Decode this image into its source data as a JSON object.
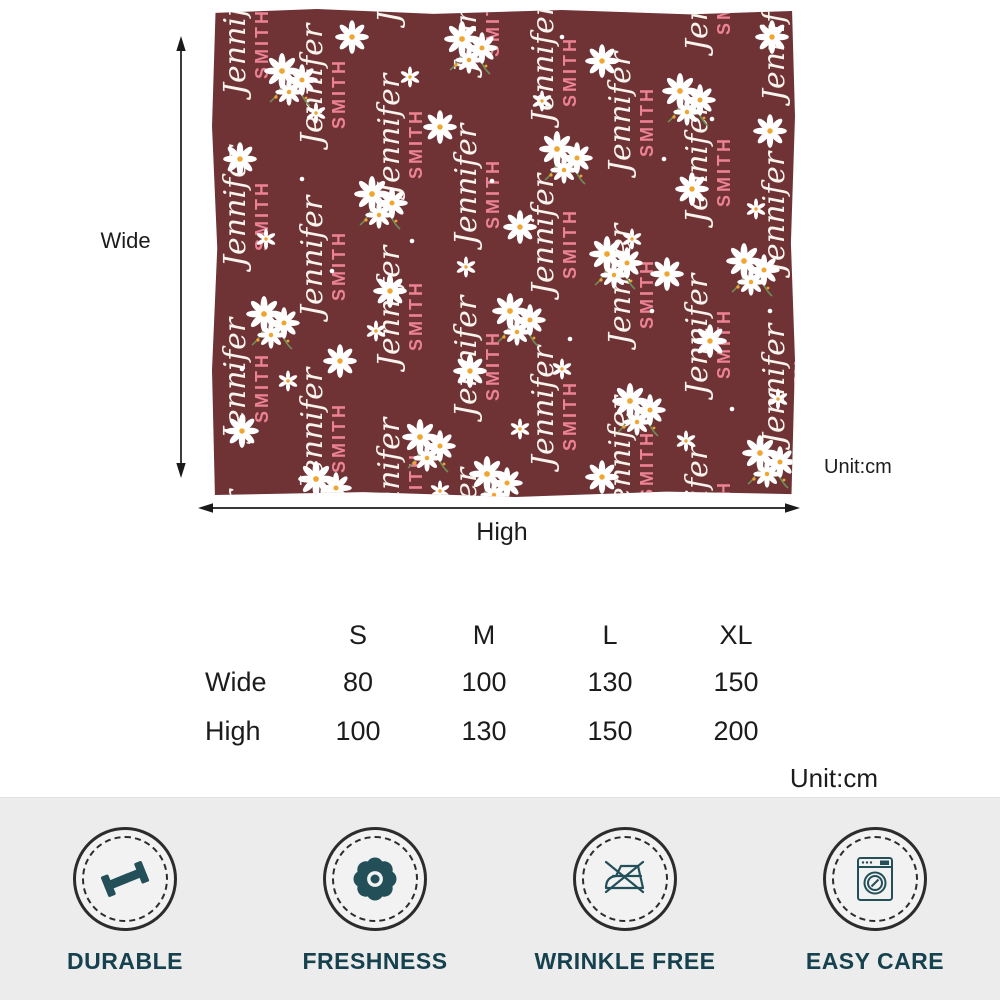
{
  "product": {
    "name_first": "Jennifer",
    "name_last": "SMITH",
    "blanket_colors": {
      "background": "#6f3336",
      "script_text": "#f8f3ec",
      "last_name_text": "#ed8295",
      "daisy_petal": "#ffffff",
      "daisy_center": "#efa52f",
      "stem": "#6f8f58"
    }
  },
  "dimension_labels": {
    "wide": "Wide",
    "high": "High",
    "unit": "Unit:cm"
  },
  "size_table": {
    "columns": [
      "S",
      "M",
      "L",
      "XL"
    ],
    "rows": [
      {
        "label": "Wide",
        "values": [
          80,
          100,
          130,
          150
        ]
      },
      {
        "label": "High",
        "values": [
          100,
          130,
          150,
          200
        ]
      }
    ],
    "unit": "Unit:cm"
  },
  "features": [
    {
      "label": "DURABLE",
      "icon": "dumbbell-icon"
    },
    {
      "label": "FRESHNESS",
      "icon": "flower-icon"
    },
    {
      "label": "WRINKLE FREE",
      "icon": "no-iron-icon"
    },
    {
      "label": "EASY CARE",
      "icon": "washing-machine-icon"
    }
  ],
  "theme": {
    "feature_text_color": "#15424e",
    "icon_color": "#234f59",
    "band_background": "#ececec",
    "circle_stroke": "#2c2c2c",
    "arrow_color": "#1a1a1a"
  }
}
